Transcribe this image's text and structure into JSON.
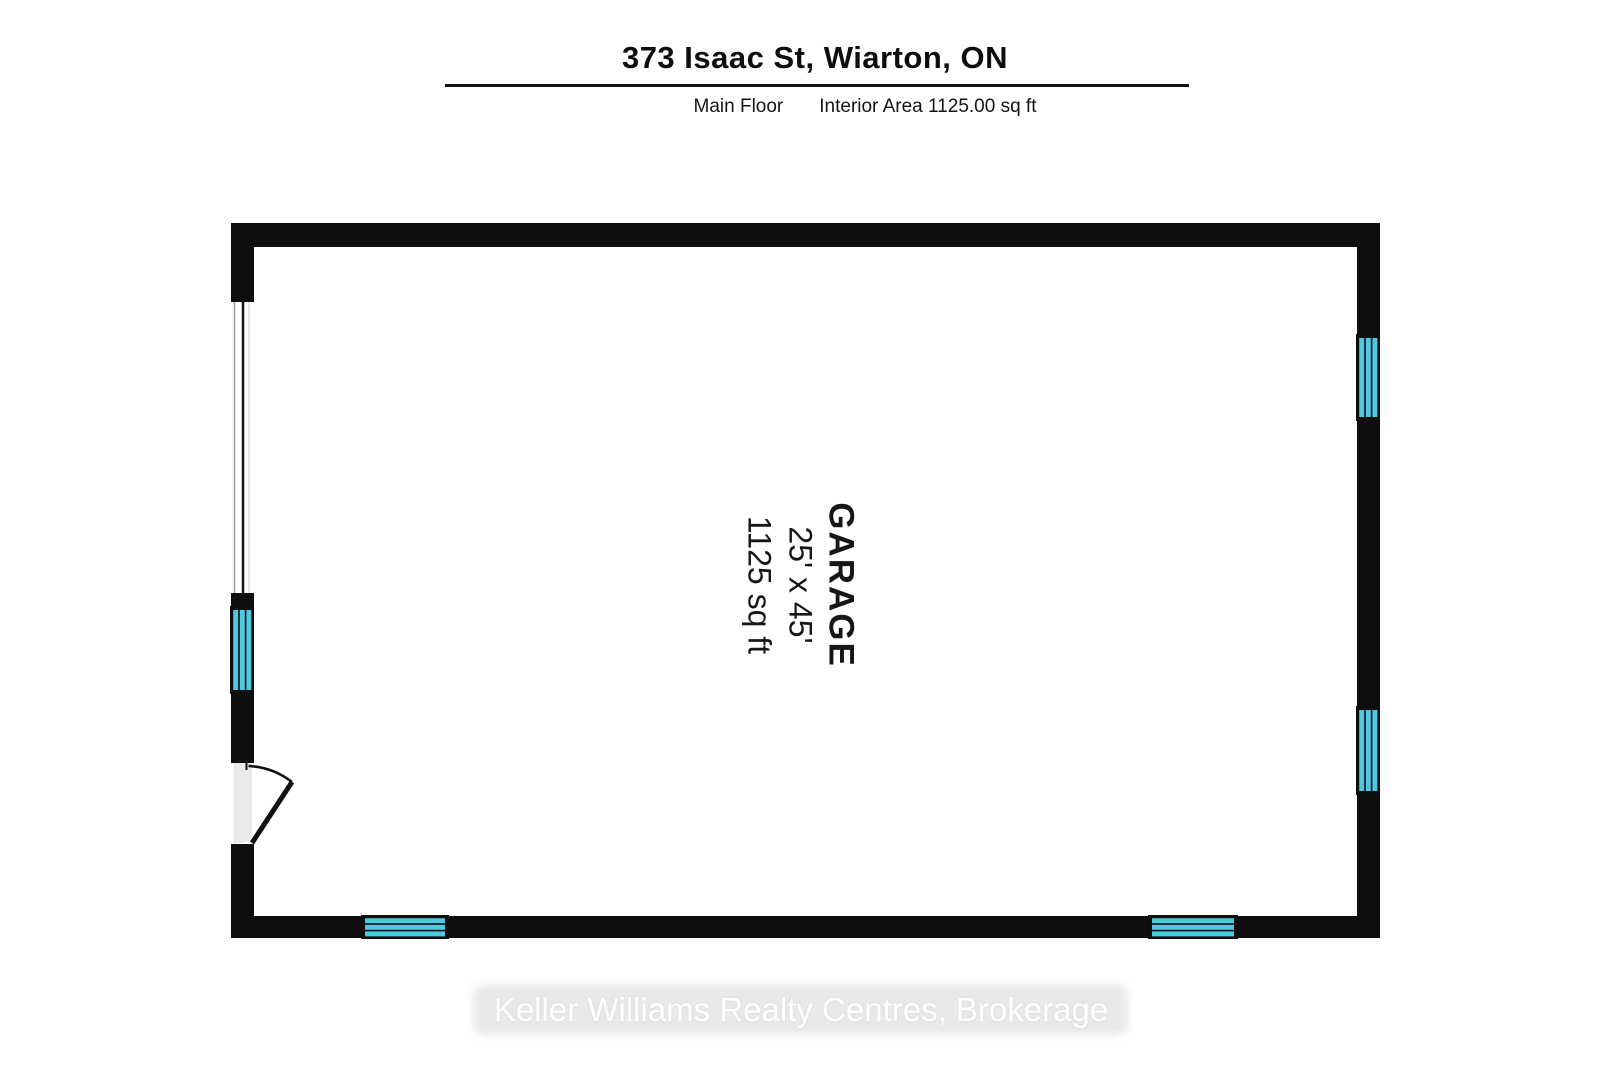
{
  "header": {
    "title": "373 Isaac St, Wiarton, ON",
    "floor_label": "Main Floor",
    "area_label": "Interior Area 1125.00 sq ft"
  },
  "room": {
    "name": "GARAGE",
    "dimensions": "25' x 45'",
    "area": "1125 sq ft"
  },
  "watermark": "Keller Williams Realty Centres, Brokerage",
  "colors": {
    "wall": "#0e0e0e",
    "window_glass": "#4ec7e0",
    "door_slab": "#e9e9e9",
    "watermark_band": "#e8e8e8",
    "watermark_text": "#fefefe"
  }
}
